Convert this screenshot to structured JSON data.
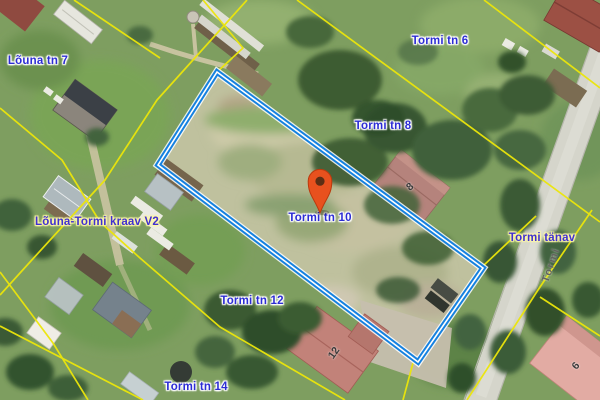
{
  "map": {
    "description": "Aerial cadastral map with highlighted parcel",
    "parcel_labels": {
      "louna7": "Lõuna tn 7",
      "tormi6": "Tormi tn 6",
      "tormi8": "Tormi tn 8",
      "tormi10": "Tormi tn 10",
      "tormi12": "Tormi tn 12",
      "tormi14": "Tormi tn 14"
    },
    "waterway_label": "Lõuna-Tormi kraav V2",
    "street_label": "Tormi tänav",
    "road_name_on_surface": "Tormi",
    "building_numbers": {
      "b8": "8",
      "b12": "12",
      "b6": "6"
    },
    "colors": {
      "highlighted_parcel_border": "#1581e0",
      "cadastral_boundary": "#ece60a",
      "address_label_text": "#2c2cd4",
      "infrastructure_label_text": "#4030d0",
      "marker_pin": "#e8511e",
      "road_surface": "#d5d5cb"
    }
  }
}
